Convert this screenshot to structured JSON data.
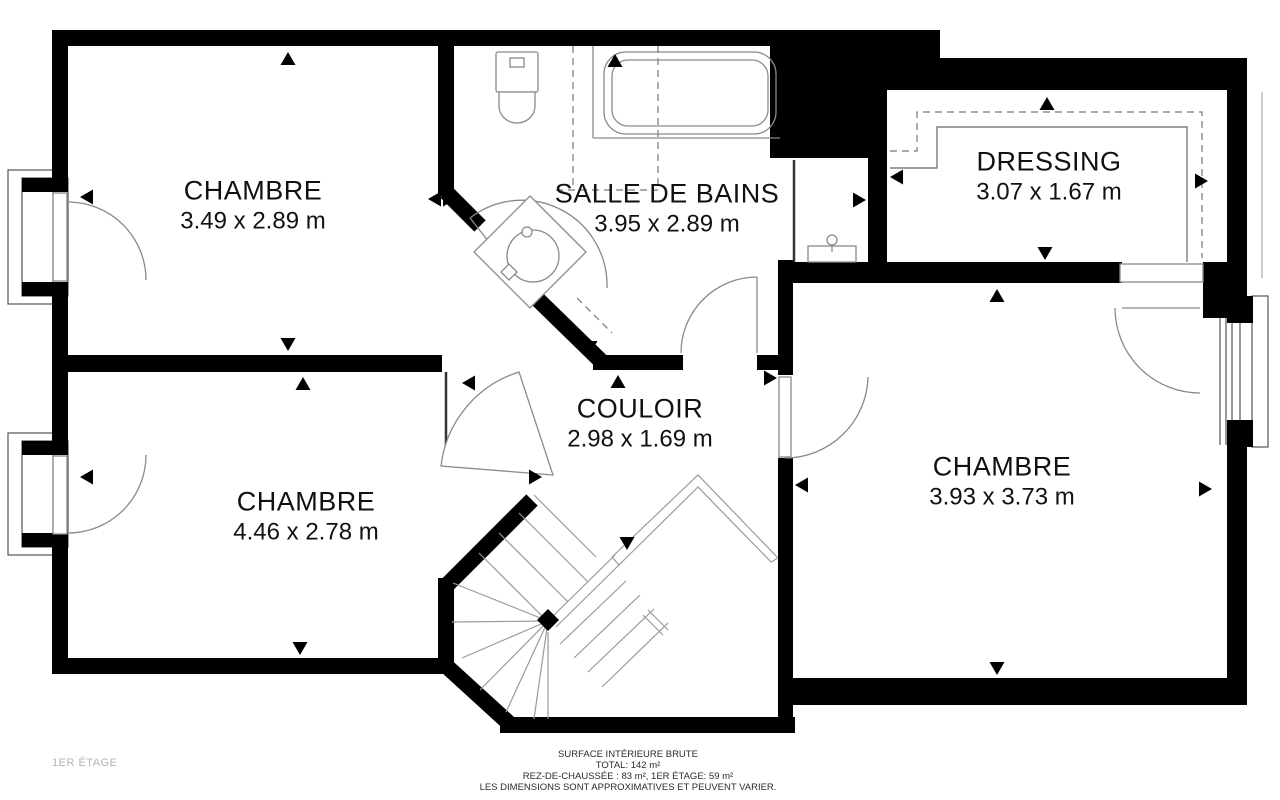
{
  "floor_label": "1ER ÉTAGE",
  "rooms": [
    {
      "name": "CHAMBRE",
      "dimensions": "3.49 x 2.89 m"
    },
    {
      "name": "SALLE DE BAINS",
      "dimensions": "3.95 x 2.89 m"
    },
    {
      "name": "DRESSING",
      "dimensions": "3.07 x 1.67 m"
    },
    {
      "name": "COULOIR",
      "dimensions": "2.98 x 1.69 m"
    },
    {
      "name": "CHAMBRE",
      "dimensions": "4.46 x 2.78 m"
    },
    {
      "name": "CHAMBRE",
      "dimensions": "3.93 x 3.73 m"
    }
  ],
  "footer": {
    "line1": "SURFACE INTÉRIEURE BRUTE",
    "line2": "TOTAL: 142 m²",
    "line3": "REZ-DE-CHAUSSÉE : 83 m², 1ER ÉTAGE: 59 m²",
    "line4": "LES DIMENSIONS SONT APPROXIMATIVES ET PEUVENT VARIER."
  },
  "colors": {
    "wall": "#000000",
    "thin_line": "#8a8a8a",
    "dashed_line": "#777777",
    "text": "#111111",
    "muted_text": "#b3b3b3"
  }
}
